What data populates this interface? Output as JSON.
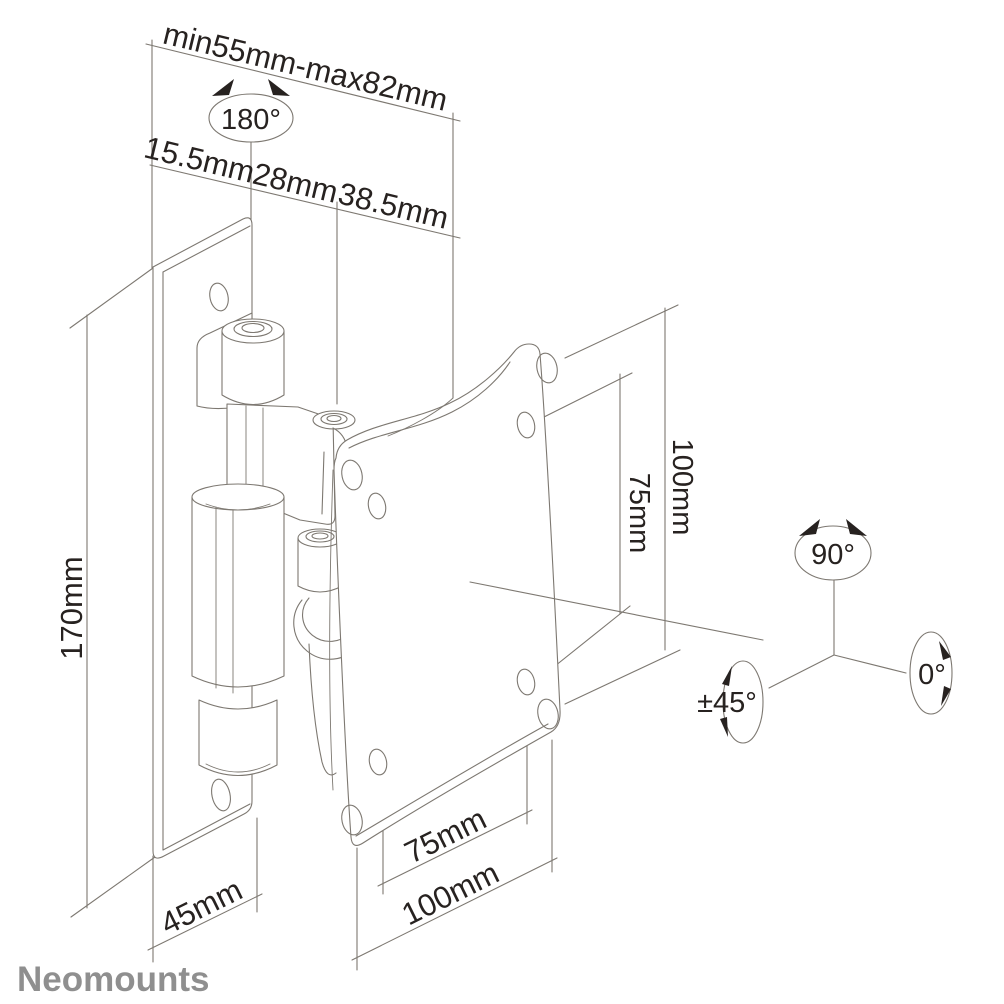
{
  "colors": {
    "line": "#7d7871",
    "text": "#272220",
    "brand": "#8f8f8f",
    "background": "#ffffff"
  },
  "brand": {
    "logo_text": "Neomounts"
  },
  "labels": {
    "depth_range": "min55mm-max82mm",
    "swivel_angle": "180°",
    "seg_wall": "15.5mm",
    "seg_hinge": "28mm",
    "seg_bracket": "38.5mm",
    "plate_height": "170mm",
    "vesa_height_100": "100mm",
    "vesa_height_75": "75mm",
    "rotate_90": "90°",
    "rotate_0": "0°",
    "tilt_45": "±45°",
    "plate_width": "45mm",
    "vesa_width_75": "75mm",
    "vesa_width_100": "100mm"
  }
}
